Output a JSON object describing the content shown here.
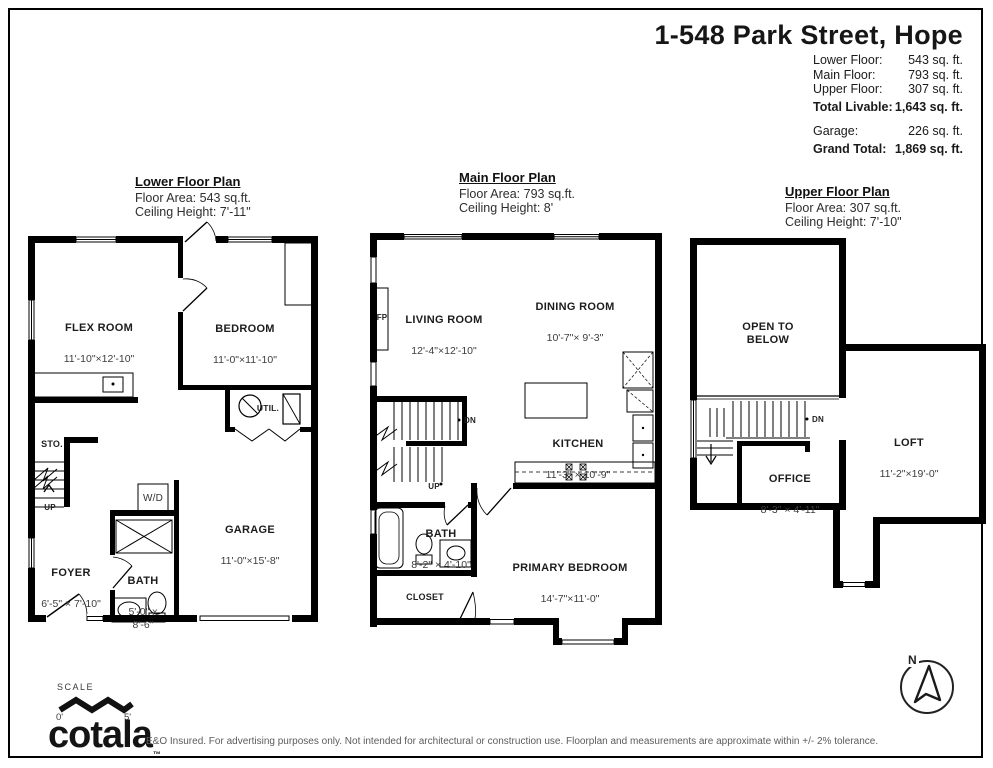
{
  "header": {
    "title": "1-548 Park Street, Hope",
    "rows": [
      {
        "label": "Lower Floor:",
        "value": "543 sq. ft."
      },
      {
        "label": "Main Floor:",
        "value": "793 sq. ft."
      },
      {
        "label": "Upper Floor:",
        "value": "307 sq. ft."
      }
    ],
    "total_livable": {
      "label": "Total Livable:",
      "value": "1,643 sq. ft."
    },
    "garage": {
      "label": "Garage:",
      "value": "226 sq. ft."
    },
    "grand_total": {
      "label": "Grand Total:",
      "value": "1,869 sq. ft."
    }
  },
  "plans": {
    "lower": {
      "title": "Lower Floor Plan",
      "floor_area": "Floor Area: 543 sq.ft.",
      "ceiling_height": "Ceiling Height: 7'-11\"",
      "rooms": {
        "flex": {
          "name": "FLEX ROOM",
          "dims": "11'-10\"×12'-10\""
        },
        "bedroom": {
          "name": "BEDROOM",
          "dims": "11'-0\"×11'-10\""
        },
        "sto": {
          "name": "STO."
        },
        "util": {
          "name": "UTIL."
        },
        "wd": {
          "name": "W/D"
        },
        "garage": {
          "name": "GARAGE",
          "dims": "11'-0\"×15'-8\""
        },
        "foyer": {
          "name": "FOYER",
          "dims": "6'-5\" × 7'-10\""
        },
        "bath": {
          "name": "BATH",
          "dims": "5'-0\" x\n8'-6\""
        },
        "up": {
          "name": "UP"
        }
      }
    },
    "main": {
      "title": "Main Floor Plan",
      "floor_area": "Floor Area: 793 sq.ft.",
      "ceiling_height": "Ceiling Height: 8'",
      "rooms": {
        "living": {
          "name": "LIVING ROOM",
          "dims": "12'-4\"×12'-10\""
        },
        "dining": {
          "name": "DINING ROOM",
          "dims": "10'-7\"× 9'-3\""
        },
        "kitchen": {
          "name": "KITCHEN",
          "dims": "11'-3\" × 10'-9\""
        },
        "fp": {
          "name": "FP"
        },
        "dn": {
          "name": "DN"
        },
        "up": {
          "name": "UP"
        },
        "bath": {
          "name": "BATH",
          "dims": "8'-2\" × 4'-10\""
        },
        "closet": {
          "name": "CLOSET"
        },
        "primary": {
          "name": "PRIMARY BEDROOM",
          "dims": "14'-7\"×11'-0\""
        }
      }
    },
    "upper": {
      "title": "Upper Floor Plan",
      "floor_area": "Floor Area: 307 sq.ft.",
      "ceiling_height": "Ceiling Height: 7'-10\"",
      "rooms": {
        "open_below": {
          "name": "OPEN TO\nBELOW"
        },
        "loft": {
          "name": "LOFT",
          "dims": "11'-2\"×19'-0\""
        },
        "office": {
          "name": "OFFICE",
          "dims": "8'-3\" × 4'-11\""
        },
        "dn": {
          "name": "DN"
        }
      }
    }
  },
  "footer": {
    "scale_label": "SCALE",
    "scale_start": "0'",
    "scale_end": "5'",
    "logo": "cotala",
    "logo_tm": "™",
    "disclaimer": "E&O Insured. For advertising purposes only. Not intended for architectural or construction use. Floorplan and measurements are approximate within +/- 2% tolerance."
  },
  "compass": {
    "north": "N"
  }
}
